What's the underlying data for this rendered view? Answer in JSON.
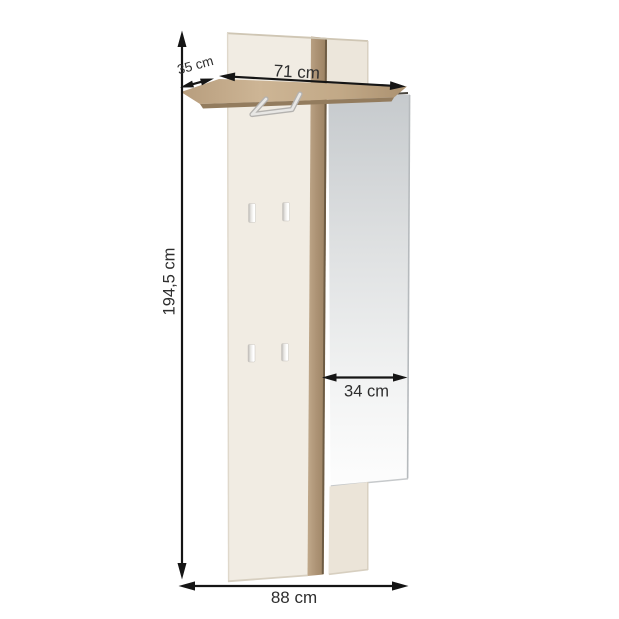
{
  "diagram": {
    "type": "furniture-dimension-diagram",
    "product": "wall-mounted hallway coat rack panel with shelf, hooks and mirror",
    "labels": {
      "height": "194,5 cm",
      "shelf_width": "71 cm",
      "shelf_depth": "35 cm",
      "mirror_width": "34 cm",
      "total_width": "88 cm"
    },
    "colors": {
      "background": "#ffffff",
      "panel": "#f1ece3",
      "panel_right": "#ece6db",
      "panel_lower": "#ebe4d8",
      "panel_edge": "#d7cfc0",
      "strip_light": "#c0a98b",
      "strip_mid": "#ad9375",
      "strip_dark": "#9a8161",
      "strip_edge": "#6e5c44",
      "shelf_left": "#b79d7d",
      "shelf_mid": "#cdb595",
      "shelf_right": "#ab9170",
      "shelf_front": "#937c5e",
      "mirror_top": "#c6cacd",
      "mirror_mid": "#dfe1e2",
      "mirror_bottom": "#fdfdfd",
      "mirror_edge": "#b6babd",
      "hook_shadow": "#b9b6b2",
      "hook_light": "#ffffff",
      "rail_outer": "#b4b2af",
      "rail_inner": "#e8e7e5",
      "dimension_line": "#151515",
      "label_text": "#2e2e2e"
    }
  }
}
